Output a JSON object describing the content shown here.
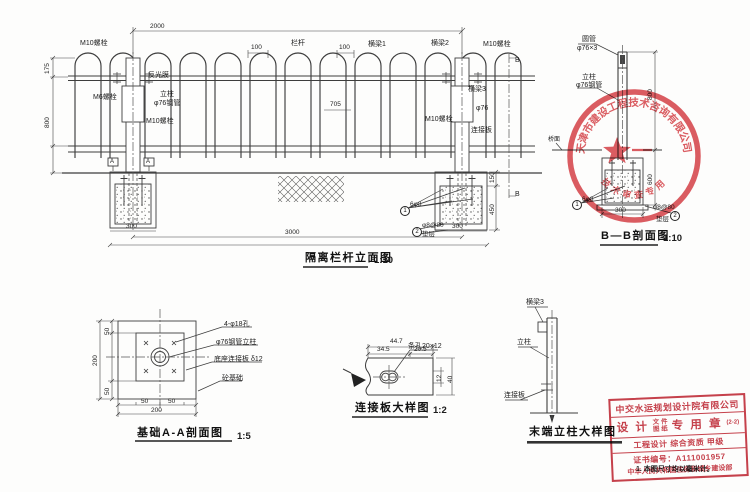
{
  "ele": {
    "title": "隔离栏杆立面图",
    "scale": "1:10",
    "m10a": "M10螺栓",
    "fgm": "反光膜",
    "m6": "M6螺栓",
    "lz": "立柱",
    "g76": "φ76钢管",
    "m10b": "M10螺栓",
    "lg": "栏杆",
    "hl1": "横梁1",
    "hl2": "横梁2",
    "m10c": "M10螺栓",
    "hl3": "横梁3",
    "p76": "φ76",
    "m10d": "M10螺栓",
    "ljb": "连接板",
    "ma": "A",
    "mb": "B",
    "d2000": "2000",
    "d100a": "100",
    "d100b": "100",
    "d705": "705",
    "dh1": "175",
    "dh2": "800",
    "df1": "300",
    "df2": "300",
    "d3000": "3000",
    "dv1": "150",
    "dv2": "450",
    "c1": "1",
    "c1t": "6φ8",
    "c2": "2",
    "c2t": "φ8@80",
    "dc": "垫层"
  },
  "bb": {
    "title": "B—B剖面图",
    "scale": "1:10",
    "cap1": "圆管",
    "cap2": "φ76×3",
    "lz": "立柱",
    "g76": "φ76钢管",
    "qm": "桥面",
    "c1": "1",
    "c1t": "6φ8",
    "c2": "2",
    "c2t": "φ8@80",
    "dc": "垫层",
    "d300": "300",
    "dh1": "800",
    "dh2": "600"
  },
  "aa": {
    "title": "基础A-A剖面图",
    "scale": "1:5",
    "l1": "4-φ18孔",
    "l2": "φ76钢管立柱",
    "l3": "底座连接板 δ12",
    "l4": "砼基础",
    "d50a": "50",
    "d50b": "50",
    "d50c": "50",
    "d50d": "50",
    "d200a": "200",
    "d200b": "200"
  },
  "pl": {
    "title": "连接板大样图",
    "scale": "1:2",
    "slot": "条孔20×12",
    "d1": "44.7",
    "d2": "34.5",
    "d3": "20.5",
    "d4": "12",
    "d5": "40"
  },
  "ep": {
    "title": "末端立柱大样图",
    "hl3": "横梁3",
    "lz": "立柱",
    "ljb": "连接板"
  },
  "seal": {
    "arc": "天津市建设工程技术咨询有限公司",
    "arc2": "技术审查专用章"
  },
  "box": {
    "l1": "中交水运规划设计院有限公司",
    "a": "设 计",
    "b1": "文 件",
    "b2": "图 纸",
    "c": "专 用 章",
    "d": "(2-2)",
    "l3": "工程设计  综合资质  甲级",
    "l4": "证书编号：A111001957",
    "l5": "中华人民共和国住房和城乡建设部"
  },
  "note": "1. 本图尺寸均以毫米计。"
}
